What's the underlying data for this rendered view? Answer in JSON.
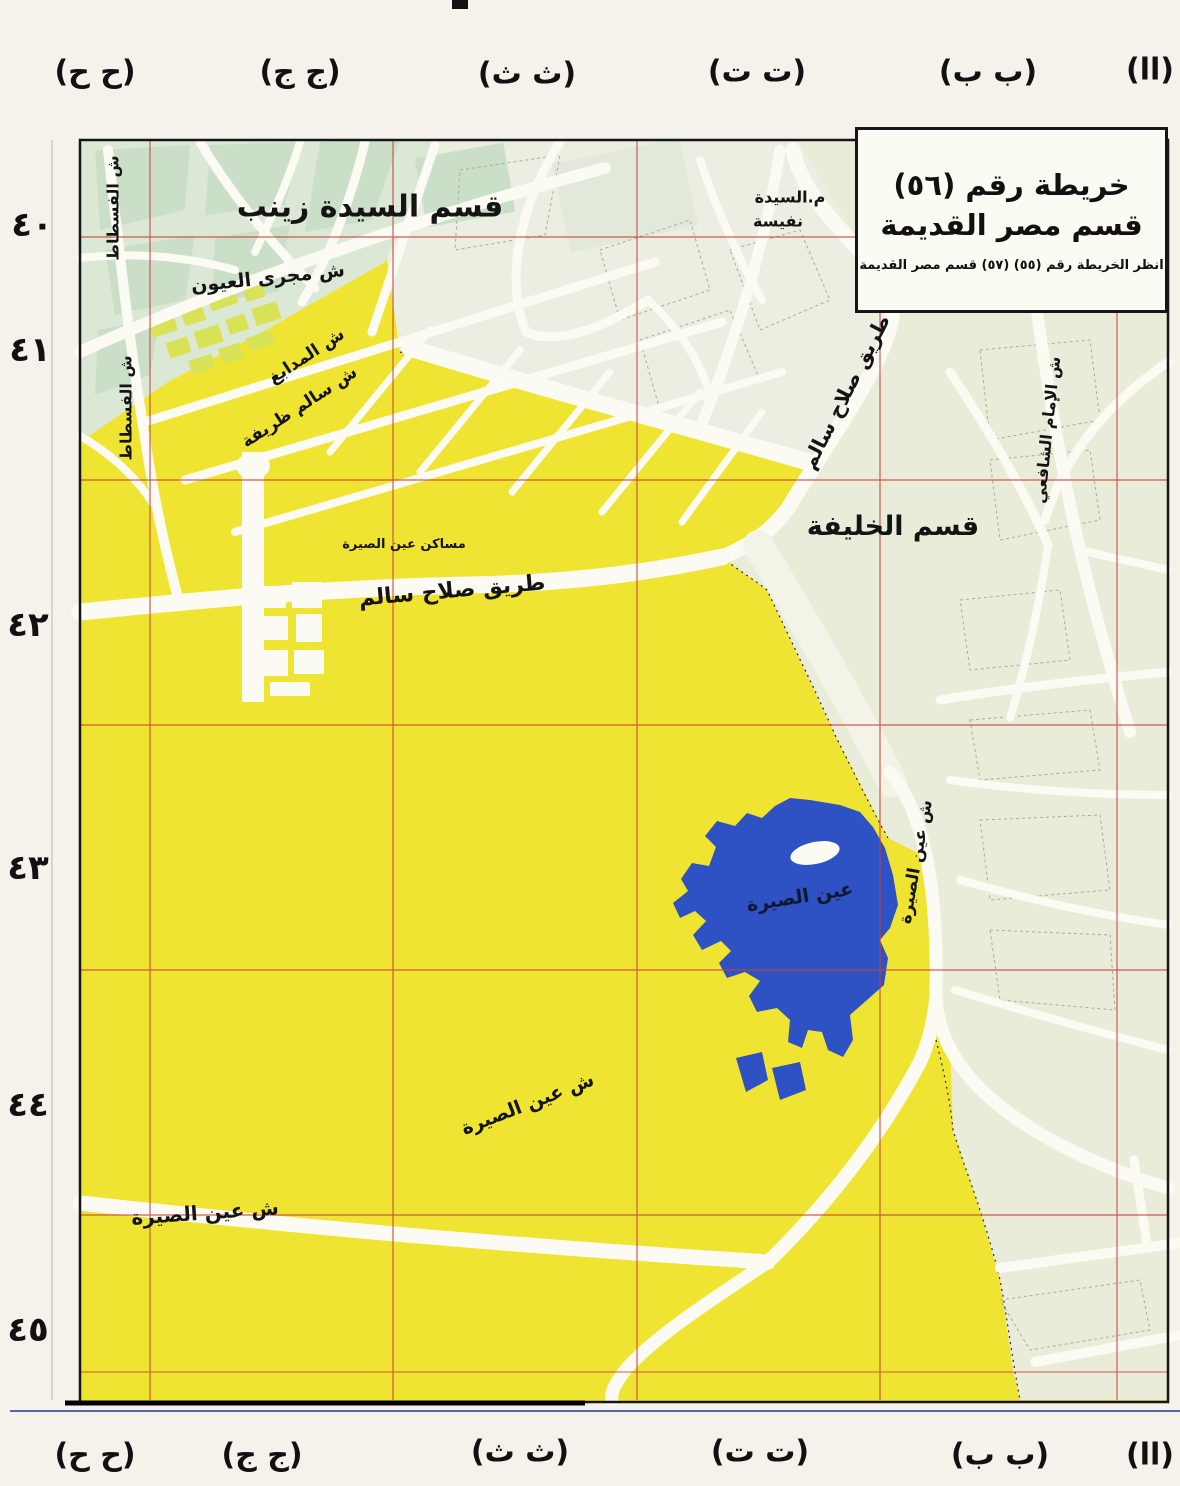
{
  "title_box": {
    "line1": "خريطة رقم (٥٦)",
    "line2": "قسم مصر القديمة",
    "line3": "انظر الخريطة رقم (٥٥) (٥٧)   قسم مصر القديمة"
  },
  "margins": {
    "top": [
      "(ح ح)",
      "(ج ج)",
      "(ث ث)",
      "(ت ت)",
      "(ب ب)",
      "(اا)"
    ],
    "bottom": [
      "(ح ح)",
      "(ج ج)",
      "(ث ث)",
      "(ت ت)",
      "(ب ب)",
      "(اا)"
    ],
    "left": [
      "٤٠",
      "٤١",
      "٤٢",
      "٤٣",
      "٤٤",
      "٤٥"
    ]
  },
  "labels": {
    "district_sayeda_zeinab": "قسم السيدة زينب",
    "m_sayeda": "م.السيدة",
    "nafisa": "نفيسة",
    "magra_el_oyoun_st": "ش مجرى العيون",
    "madabegh_st": "ش المدابغ",
    "salem_zarifa_st": "ش سالم ظريفة",
    "fustat_st_1": "ش الفسطاط",
    "fustat_st_2": "ش الفسطاط",
    "salah_salem_rd_diag": "طريق صلاح سالم",
    "district_khalifa": "قسم الخليفة",
    "imam_shafii_st": "ش الإمام الشافعي",
    "ain_el_sira_lake": "عين الصيرة",
    "ain_el_sira_st_lakeside": "ش عين الصيرة",
    "ain_el_sira_st_diag": "ش عين الصيرة",
    "ain_el_sira_st_left": "ش عين الصيرة",
    "masaken_ain_el_sira": "مساكن عين الصيرة",
    "salah_salem_rd_horiz": "طريق صلاح سالم"
  },
  "colors": {
    "paper": "#f4f2ea",
    "map_yellow": "#f0e433",
    "green_zone": "#dce8d6",
    "pale_zone": "#eceee2",
    "cream_zone": "#eaecda",
    "road_white": "#fbfbf3",
    "lake_blue": "#2e51c4",
    "grid_red": "#c8413a",
    "frame_black": "#15151a"
  }
}
